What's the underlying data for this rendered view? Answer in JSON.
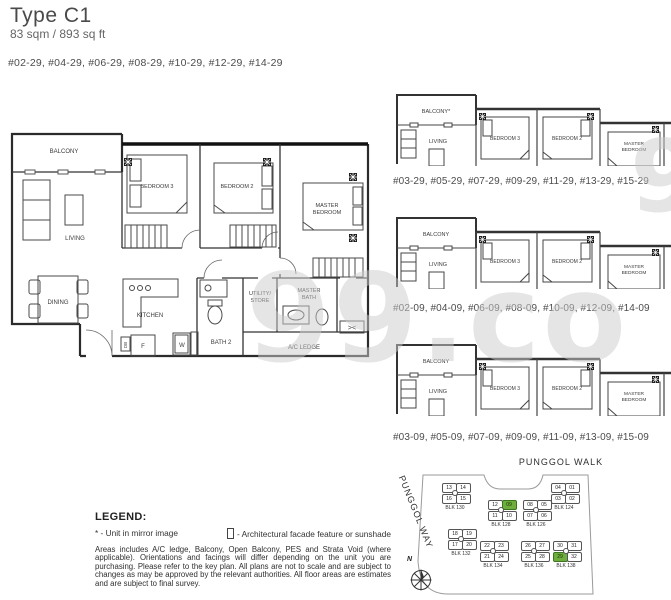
{
  "header": {
    "title": "Type C1",
    "area": "83 sqm / 893 sq ft",
    "units": "#02-29, #04-29, #06-29, #08-29, #10-29, #12-29, #14-29"
  },
  "watermark": {
    "text": "99.co"
  },
  "colors": {
    "highlight": "#6fae3e",
    "watermark": "#cccccc"
  },
  "main_plan": {
    "balcony": "BALCONY",
    "living": "LIVING",
    "bedroom3": "BEDROOM 3",
    "bedroom2": "BEDROOM 2",
    "master1": "MASTER",
    "master2": "BEDROOM",
    "dining": "DINING",
    "kitchen": "KITCHEN",
    "utility1": "UTILITY/",
    "utility2": "STORE",
    "mbath1": "MASTER",
    "mbath2": "BATH",
    "bath2": "BATH 2",
    "ac_ledge": "A/C LEDGE",
    "louver": "><",
    "fridge": "F",
    "washer": "W",
    "db": "DB"
  },
  "mini_plans": [
    {
      "balcony": "BALCONY*",
      "living": "LIVING",
      "bedroom3": "BEDROOM 3",
      "bedroom2": "BEDROOM 2",
      "master1": "MASTER",
      "master2": "BEDROOM",
      "units": "#03-29, #05-29, #07-29, #09-29, #11-29, #13-29, #15-29"
    },
    {
      "balcony": "BALCONY",
      "living": "LIVING",
      "bedroom3": "BEDROOM 3",
      "bedroom2": "BEDROOM 2",
      "master1": "MASTER",
      "master2": "BEDROOM",
      "units": "#02-09, #04-09, #06-09, #08-09, #10-09, #12-09, #14-09"
    },
    {
      "balcony": "BALCONY",
      "living": "LIVING",
      "bedroom3": "BEDROOM 3",
      "bedroom2": "BEDROOM 2",
      "master1": "MASTER",
      "master2": "BEDROOM",
      "units": "#03-09, #05-09, #07-09, #09-09, #11-09, #13-09, #15-09"
    }
  ],
  "legend": {
    "heading": "LEGEND:",
    "item_mirror": "* - Unit in mirror image",
    "item_facade": "- Architectural facade feature or sunshade",
    "disclaimer": "Areas includes A/C ledge, Balcony, Open Balcony, PES and Strata Void (where applicable). Orientations and facings will differ depending on the unit you are purchasing. Please refer to the key plan. All plans are not to scale and are subject to changes as may be approved by the relevant authorities. All floor areas are estimates and are subject to final survey."
  },
  "siteplan": {
    "road_top": "PUNGGOL WALK",
    "road_left": "PUNGGOL WAY",
    "north_label": "N",
    "blocks": [
      {
        "name": "BLK 130",
        "units": [
          "13",
          "14",
          "16",
          "15"
        ]
      },
      {
        "name": "BLK 128",
        "units": [
          "12",
          "09",
          "11",
          "10"
        ]
      },
      {
        "name": "BLK 126",
        "units": [
          "08",
          "05",
          "07",
          "06"
        ]
      },
      {
        "name": "BLK 124",
        "units": [
          "04",
          "01",
          "03",
          "02"
        ]
      },
      {
        "name": "BLK 132",
        "units": [
          "18",
          "19",
          "17",
          "20"
        ]
      },
      {
        "name": "BLK 134",
        "units": [
          "22",
          "23",
          "21",
          "24"
        ]
      },
      {
        "name": "BLK 136",
        "units": [
          "26",
          "27",
          "25",
          "28"
        ]
      },
      {
        "name": "BLK 138",
        "units": [
          "30",
          "31",
          "29",
          "32"
        ]
      }
    ]
  }
}
